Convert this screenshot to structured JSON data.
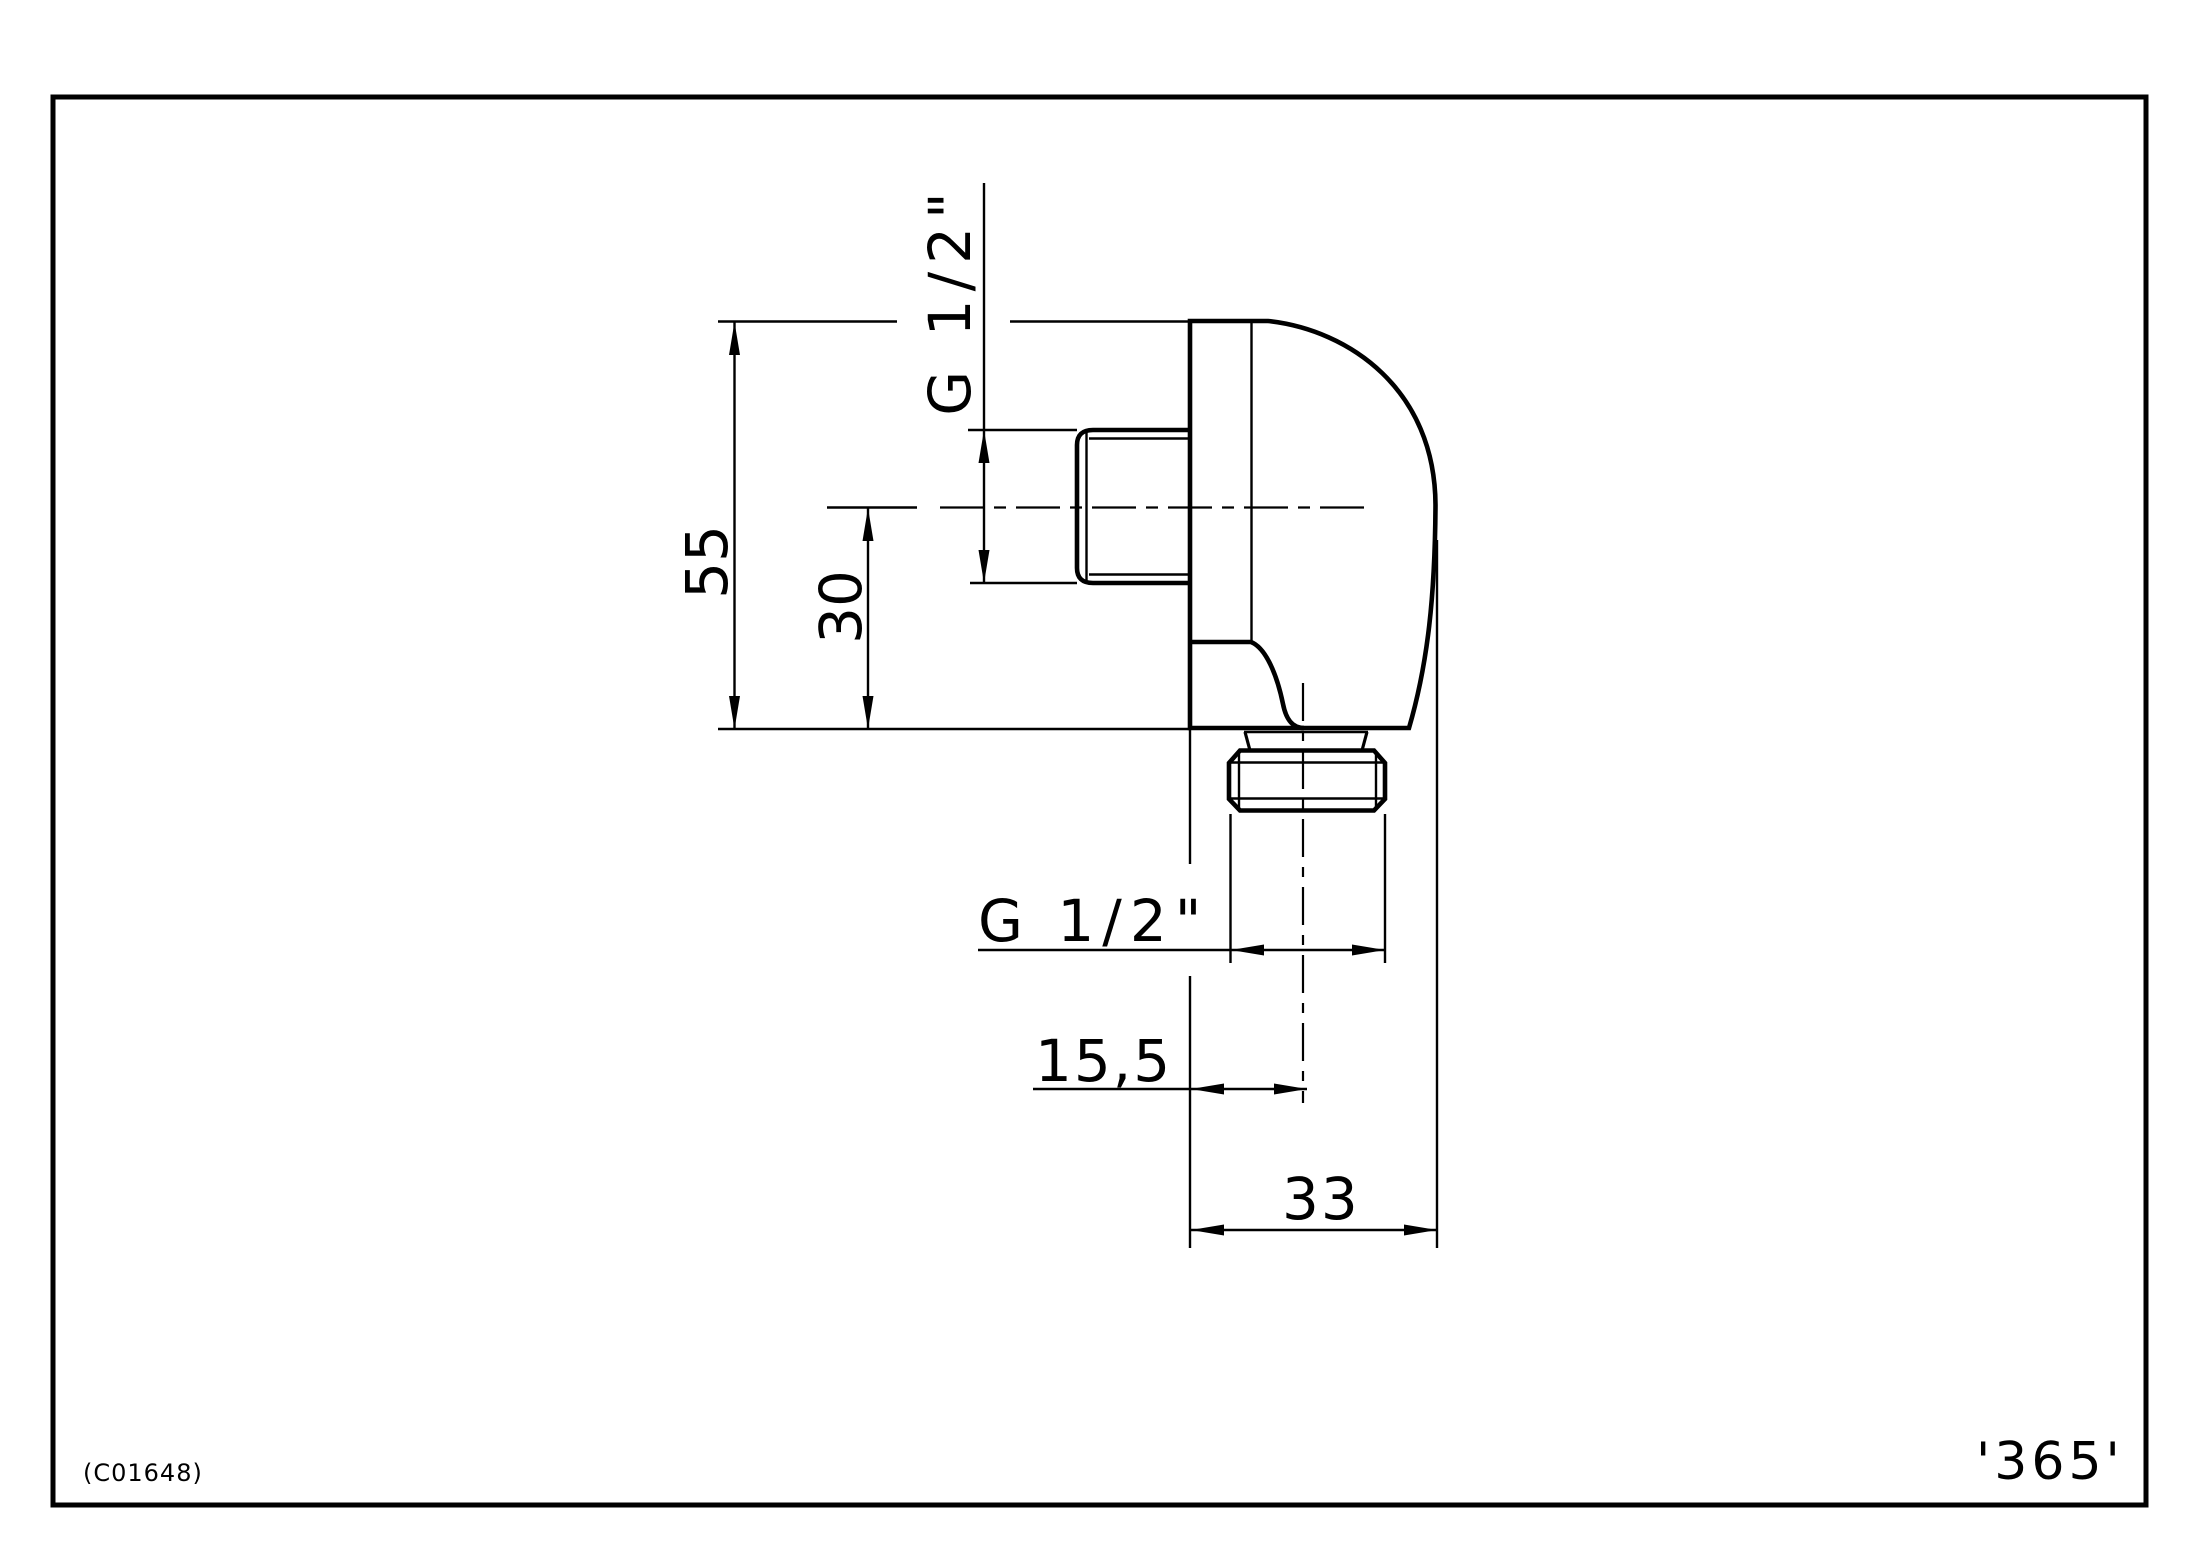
{
  "page": {
    "background": "#ffffff",
    "line_color": "#000000"
  },
  "drawing": {
    "type": "technical-drawing",
    "subject": "wall-elbow-fitting-side-view",
    "dimensions": {
      "total_height": "55",
      "center_height": "30",
      "side_thread": "G 1/2\"",
      "bottom_thread": "G 1/2\"",
      "port_offset": "15,5",
      "total_width": "33"
    },
    "footer": {
      "doc_code": "(C01648)",
      "page_number": "'365'"
    }
  }
}
